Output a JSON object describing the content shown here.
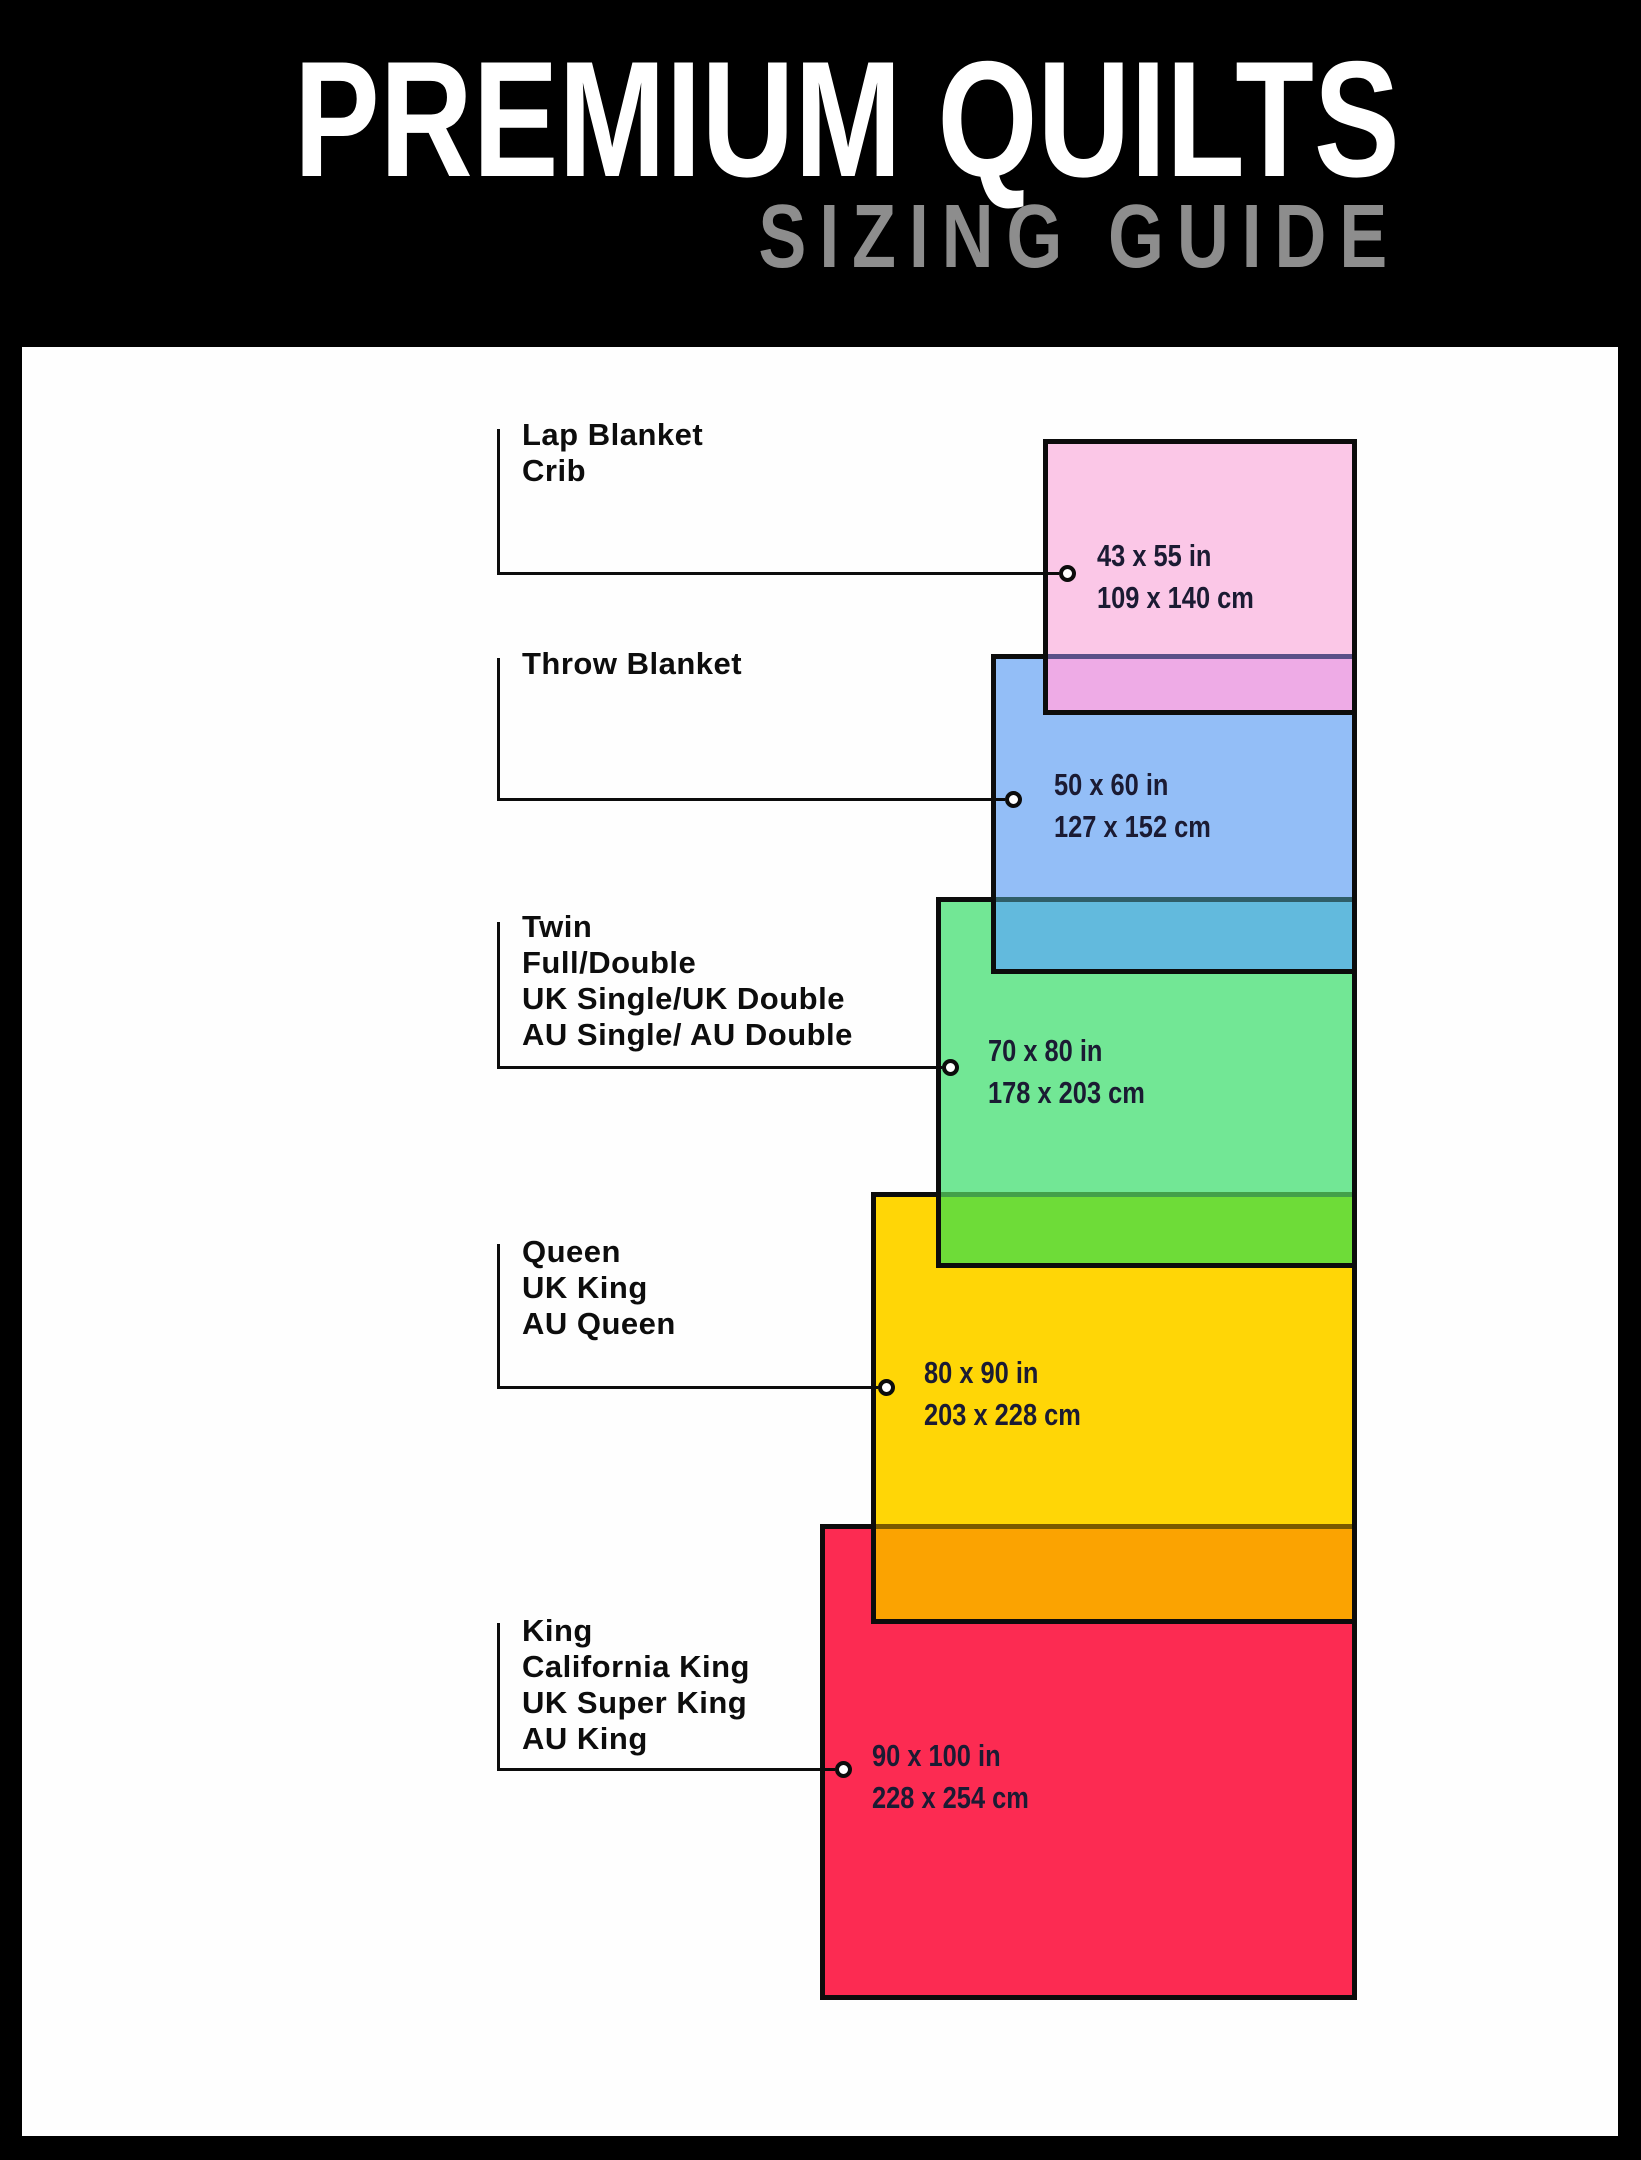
{
  "header": {
    "title": "PREMIUM QUILTS",
    "subtitle": "SIZING GUIDE"
  },
  "items": [
    {
      "id": "lap-crib",
      "name_lines": [
        "Lap Blanket",
        "Crib"
      ],
      "size_in": "43 x 55 in",
      "size_cm": "109 x 140 cm",
      "fill": "#fbc7e7",
      "overlap_band": "#eeabe6",
      "overlap_line": "#5a5088"
    },
    {
      "id": "throw",
      "name_lines": [
        "Throw Blanket"
      ],
      "size_in": "50 x 60 in",
      "size_cm": "127 x 152 cm",
      "fill": "#93bef7",
      "overlap_band": "#62badd",
      "overlap_line": "#2f5e68"
    },
    {
      "id": "twin",
      "name_lines": [
        "Twin",
        "Full/Double",
        "UK Single/UK Double",
        "AU Single/ AU Double"
      ],
      "size_in": "70 x 80 in",
      "size_cm": "178 x 203 cm",
      "fill": "#72e795",
      "overlap_band": "#6edc38",
      "overlap_line": "#43a04a"
    },
    {
      "id": "queen",
      "name_lines": [
        "Queen",
        "UK King",
        "AU Queen"
      ],
      "size_in": "80 x 90 in",
      "size_cm": "203 x 228 cm",
      "fill": "#ffd606",
      "overlap_band": "#fba301",
      "overlap_line": "#7a5a00"
    },
    {
      "id": "king",
      "name_lines": [
        "King",
        "California King",
        "UK Super King",
        "AU King"
      ],
      "size_in": "90 x 100 in",
      "size_cm": "228 x 254 cm",
      "fill": "#fc2b52",
      "overlap_band": null,
      "overlap_line": null
    }
  ],
  "colors": {
    "background": "#000000",
    "board": "#fefefe",
    "title": "#ffffff",
    "subtitle": "#8d8d8d",
    "rect_border": "#0c0c0c",
    "category_text": "#0d0d0d",
    "size_text": "#1b1b33"
  }
}
